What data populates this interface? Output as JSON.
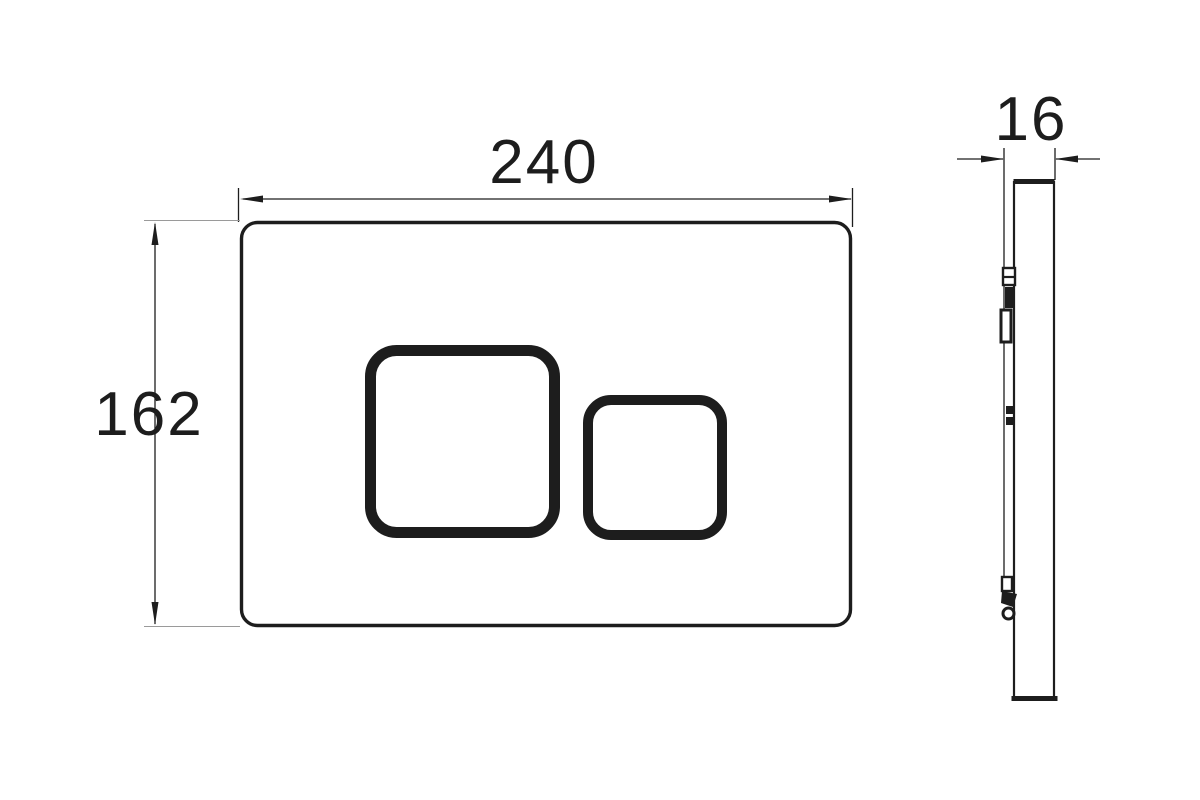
{
  "drawing": {
    "type": "technical-dimension-drawing",
    "subject": "wall flush plate with two square buttons, front view and side profile",
    "dimensions": {
      "width": "240",
      "height": "162",
      "thickness": "16"
    }
  },
  "colors": {
    "line": "#1d1d1d",
    "background": "#ffffff"
  }
}
